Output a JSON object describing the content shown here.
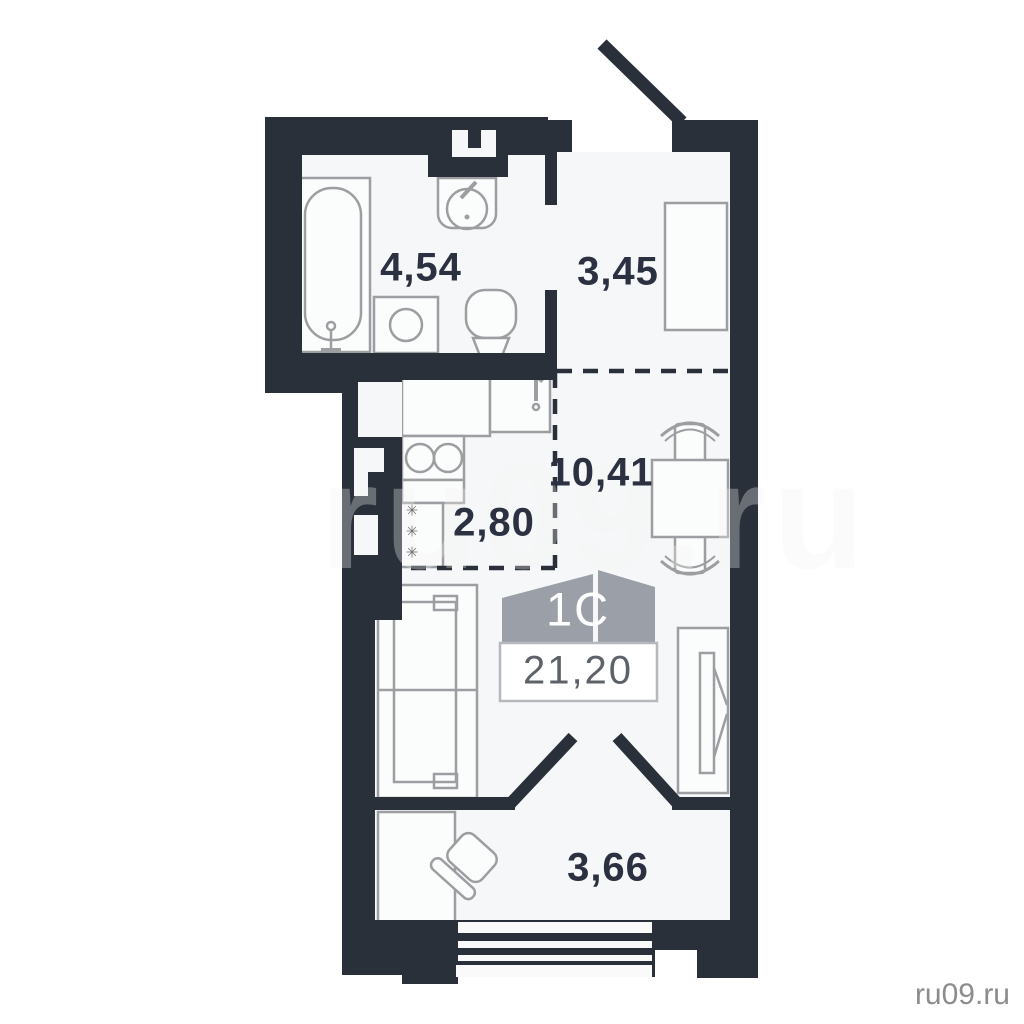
{
  "plan": {
    "unit_badge": {
      "type_label": "1С",
      "total_area": "21,20"
    },
    "rooms": {
      "bathroom": {
        "area": "4,54"
      },
      "hallway": {
        "area": "3,45"
      },
      "kitchen": {
        "area": "2,80"
      },
      "living_room": {
        "area": "10,41"
      },
      "balcony": {
        "area": "3,66"
      }
    },
    "fridge_snowflakes": "✳✳✳",
    "fixtures": [
      "bathtub",
      "bathroom-sink",
      "washing-machine",
      "toilet",
      "ventilation-shaft",
      "kitchen-counter",
      "kitchen-sink",
      "stove",
      "refrigerator",
      "hallway-wardrobe",
      "dining-table",
      "chair",
      "sofa-bed",
      "sliding-wardrobe",
      "balcony-cabinet",
      "balcony-chair",
      "entrance-door",
      "balcony-glazing"
    ]
  },
  "watermark": {
    "center": "ru09.ru",
    "corner": "ru09.ru"
  },
  "colors": {
    "wall": "#2a303a",
    "floor": "#f6f7f8",
    "fixture_outline": "#9c9ea1",
    "room_label": "#2b3140",
    "badge_banner": "#9ba0a8",
    "badge_value_text": "#5d6269",
    "corner_watermark": "#8c8c8c"
  }
}
